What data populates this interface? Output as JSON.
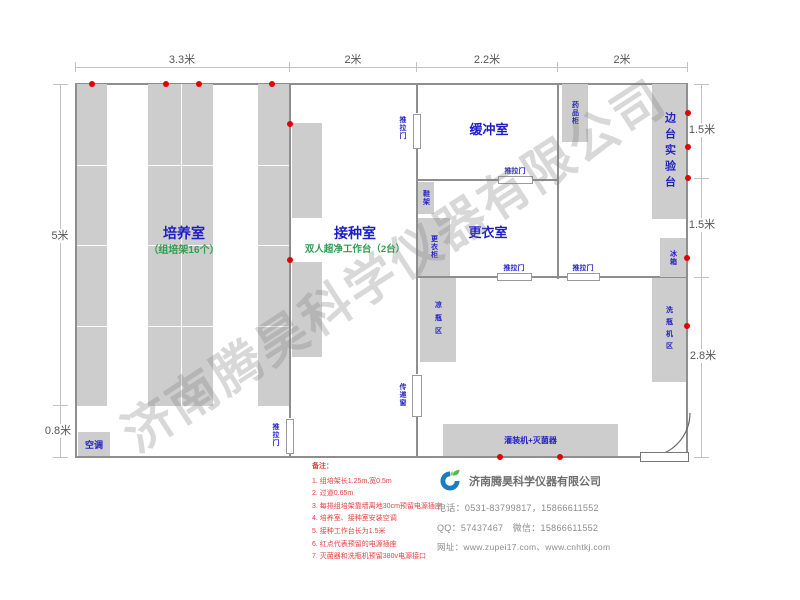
{
  "watermark": "济南腾昊科学仪器有限公司",
  "dimensions": {
    "top_33": "3.3米",
    "top_2a": "2米",
    "top_22": "2.2米",
    "top_2b": "2米",
    "left_5": "5米",
    "left_08": "0.8米",
    "right_15a": "1.5米",
    "right_15b": "1.5米",
    "right_28": "2.8米"
  },
  "rooms": {
    "culture": {
      "name": "培养室",
      "sub": "（组培架16个）"
    },
    "inoculation": {
      "name": "接种室",
      "sub": "双人超净工作台（2台）"
    },
    "buffer": {
      "name": "缓冲室"
    },
    "changing": {
      "name": "更衣室"
    }
  },
  "fixtures": {
    "sliding_door": "推拉门",
    "transfer_window": "传递窗",
    "air_conditioner": "空调",
    "shoe_rack": "鞋架",
    "wardrobe": "更衣柜",
    "medicine_cabinet": "药品柜",
    "side_bench": "边台实验台",
    "fridge": "冰箱",
    "bottle_cooling": "凉瓶区",
    "bottle_washer": "洗瓶机区",
    "filling_sterilizer": "灌装机+灭菌器"
  },
  "notes": {
    "title": "备注：",
    "items": [
      "1. 组培架长1.25m,宽0.5m",
      "2. 过道0.65m",
      "3. 每排组培架靠墙离地30cm预留电源插座",
      "4. 培养室、接种室安装空调",
      "5. 接种工作台长为1.5米",
      "6. 红点代表预留的电源插座",
      "7. 灭菌器和洗瓶机预留380v电源接口"
    ]
  },
  "company": {
    "name": "济南腾昊科学仪器有限公司",
    "phone": "电话：0531-83799817，15866611552",
    "qq": "QQ：57437467　微信：15866611552",
    "web": "网址：www.zupei17.com、www.cnhtkj.com"
  },
  "colors": {
    "label_blue": "#2323c4",
    "label_green": "#2f9e50",
    "note_red": "#e54040",
    "outlet_red": "#e30000",
    "block_gray": "#cdcdcd",
    "wall_gray": "#8e8e8e"
  }
}
